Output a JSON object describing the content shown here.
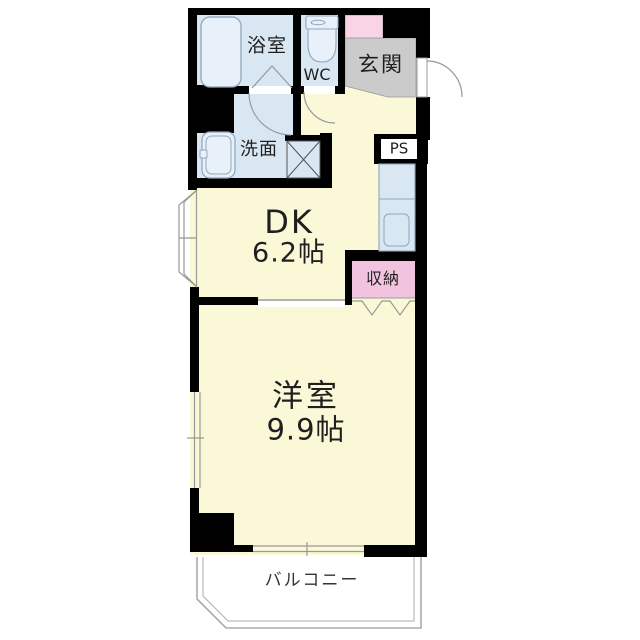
{
  "title": "1DK apartment floor plan",
  "floorplan": {
    "rooms": {
      "bathroom": {
        "label": "浴室"
      },
      "toilet": {
        "label": "WC"
      },
      "entrance": {
        "label": "玄関"
      },
      "washroom": {
        "label": "洗面"
      },
      "pipe_space": {
        "label": "PS"
      },
      "dining_kitchen": {
        "label": "DK",
        "area": "6.2帖"
      },
      "western_room": {
        "label": "洋室",
        "area": "9.9帖"
      },
      "storage": {
        "label": "収納"
      },
      "balcony": {
        "label": "バルコニー"
      }
    },
    "fixtures": [
      "bathtub",
      "toilet",
      "washbasin",
      "washer-space",
      "kitchen-counter",
      "kitchen-sink"
    ]
  },
  "colors": {
    "wall": "#000000",
    "room": "#FBF8D8",
    "wet": "#D9E7F3",
    "fixture": "#E8F1F9",
    "genkan": "#CBCBCB",
    "pink-entry": "#F9D3E6",
    "pink-closet": "#F2C3DE",
    "line": "#999999",
    "balcony-line": "#ABABAB",
    "text": "#1F1F1F"
  }
}
